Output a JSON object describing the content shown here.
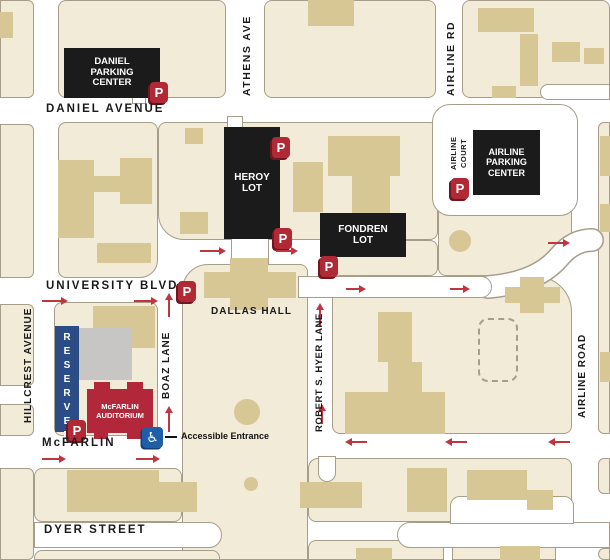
{
  "title": "Campus parking map - McFarlin Auditorium area",
  "colors": {
    "block_cream": "#f1ebd8",
    "block_border": "#a69d8b",
    "building_tan": "#d7c795",
    "building_gray": "#c7c6c4",
    "lot_black": "#1b1b1b",
    "parking_red": "#b12935",
    "arrow_red": "#c0353f",
    "reserved_blue": "#2c4c86",
    "accessible_blue": "#1f5fa8",
    "auditorium_red": "#b2283a",
    "street_white": "#ffffff"
  },
  "reserved": {
    "text": "RESERVED"
  },
  "auditorium": {
    "line1": "McFARLIN",
    "line2": "AUDITORIUM"
  },
  "accessible": {
    "symbol": "♿",
    "label": "Accessible Entrance"
  },
  "map": {
    "p_label": "P",
    "street_labels": [
      {
        "id": "daniel-avenue",
        "text": "DANIEL AVENUE",
        "x": 46,
        "y": 103,
        "size": 11.5,
        "ls": 2,
        "vertical": false
      },
      {
        "id": "university-blvd",
        "text": "UNIVERSITY BLVD",
        "x": 46,
        "y": 280,
        "size": 11.5,
        "ls": 2,
        "vertical": false
      },
      {
        "id": "mcfarlin",
        "text": "McFARLIN",
        "x": 42,
        "y": 437,
        "size": 11.5,
        "ls": 2,
        "vertical": false
      },
      {
        "id": "dyer-street",
        "text": "DYER STREET",
        "x": 44,
        "y": 524,
        "size": 11.5,
        "ls": 2,
        "vertical": false
      },
      {
        "id": "dallas-hall",
        "text": "DALLAS HALL",
        "x": 211,
        "y": 306,
        "size": 10,
        "ls": 1,
        "vertical": false
      },
      {
        "id": "athens-ave",
        "text": "ATHENS AVE",
        "x": 241,
        "y": 12,
        "h": 88,
        "size": 10.5,
        "ls": 1.5,
        "vertical": true
      },
      {
        "id": "airline-rd",
        "text": "AIRLINE RD",
        "x": 445,
        "y": 14,
        "h": 88,
        "size": 10.5,
        "ls": 1.5,
        "vertical": true
      },
      {
        "id": "airline-court-line1",
        "text": "AIRLINE",
        "x": 449,
        "y": 126,
        "h": 54,
        "size": 7.5,
        "ls": 0.5,
        "vertical": true
      },
      {
        "id": "airline-court-line2",
        "text": "COURT",
        "x": 459,
        "y": 126,
        "h": 54,
        "size": 7.5,
        "ls": 0.5,
        "vertical": true
      },
      {
        "id": "hillcrest-avenue",
        "text": "HILLCREST AVENUE",
        "x": 23,
        "y": 294,
        "h": 142,
        "size": 10,
        "ls": 1,
        "vertical": true
      },
      {
        "id": "boaz-lane",
        "text": "BOAZ LANE",
        "x": 161,
        "y": 316,
        "h": 98,
        "size": 10,
        "ls": 1,
        "vertical": true
      },
      {
        "id": "robert-s-hyer-lane",
        "text": "ROBERT S. HYER LANE",
        "x": 314,
        "y": 282,
        "h": 182,
        "size": 9.5,
        "ls": 0.5,
        "vertical": true
      },
      {
        "id": "airline-road",
        "text": "AIRLINE ROAD",
        "x": 577,
        "y": 314,
        "h": 124,
        "size": 10,
        "ls": 1,
        "vertical": true
      }
    ],
    "lots": [
      {
        "id": "daniel-parking-center",
        "lines": [
          "DANIEL",
          "PARKING",
          "CENTER"
        ],
        "x": 64,
        "y": 48,
        "w": 96,
        "h": 50,
        "size": 9.5
      },
      {
        "id": "heroy-lot",
        "lines": [
          "HEROY",
          "LOT"
        ],
        "x": 224,
        "y": 127,
        "w": 56,
        "h": 112,
        "size": 10
      },
      {
        "id": "fondren-lot",
        "lines": [
          "FONDREN",
          "LOT"
        ],
        "x": 320,
        "y": 213,
        "w": 86,
        "h": 44,
        "size": 10
      },
      {
        "id": "airline-parking-center",
        "lines": [
          "AIRLINE",
          "PARKING",
          "CENTER"
        ],
        "x": 473,
        "y": 130,
        "w": 67,
        "h": 65,
        "size": 9
      }
    ],
    "p_signs": [
      {
        "x": 150,
        "y": 82
      },
      {
        "x": 272,
        "y": 137
      },
      {
        "x": 274,
        "y": 228
      },
      {
        "x": 320,
        "y": 256
      },
      {
        "x": 178,
        "y": 281
      },
      {
        "x": 451,
        "y": 178
      },
      {
        "x": 68,
        "y": 420
      }
    ],
    "arrows": [
      {
        "x": 42,
        "y": 297,
        "dir": "right",
        "len": 26
      },
      {
        "x": 134,
        "y": 297,
        "dir": "right",
        "len": 24
      },
      {
        "x": 200,
        "y": 247,
        "dir": "right",
        "len": 26
      },
      {
        "x": 276,
        "y": 247,
        "dir": "right",
        "len": 22
      },
      {
        "x": 346,
        "y": 285,
        "dir": "right",
        "len": 20
      },
      {
        "x": 450,
        "y": 285,
        "dir": "right",
        "len": 20
      },
      {
        "x": 548,
        "y": 239,
        "dir": "right",
        "len": 22
      },
      {
        "x": 42,
        "y": 455,
        "dir": "right",
        "len": 24
      },
      {
        "x": 136,
        "y": 455,
        "dir": "right",
        "len": 24
      },
      {
        "x": 165,
        "y": 293,
        "dir": "up",
        "len": 24
      },
      {
        "x": 165,
        "y": 406,
        "dir": "up",
        "len": 26
      },
      {
        "x": 316,
        "y": 303,
        "dir": "up",
        "len": 24
      },
      {
        "x": 318,
        "y": 404,
        "dir": "up",
        "len": 20
      },
      {
        "x": 345,
        "y": 438,
        "dir": "left",
        "len": 22
      },
      {
        "x": 445,
        "y": 438,
        "dir": "left",
        "len": 22
      },
      {
        "x": 548,
        "y": 438,
        "dir": "left",
        "len": 22
      }
    ],
    "blocks": [
      {
        "x": 0,
        "y": 0,
        "w": 34,
        "h": 98,
        "r": "0 6px 6px 0"
      },
      {
        "x": 0,
        "y": 124,
        "w": 34,
        "h": 154,
        "r": "0 6px 6px 0"
      },
      {
        "x": 0,
        "y": 304,
        "w": 34,
        "h": 82,
        "r": "0 6px 6px 0"
      },
      {
        "x": 0,
        "y": 404,
        "w": 34,
        "h": 32,
        "r": "0 6px 6px 0"
      },
      {
        "x": 0,
        "y": 468,
        "w": 34,
        "h": 92,
        "r": "0 6px 6px 0"
      },
      {
        "x": 58,
        "y": 0,
        "w": 168,
        "h": 98,
        "r": "8px"
      },
      {
        "x": 264,
        "y": 0,
        "w": 172,
        "h": 98,
        "r": "8px"
      },
      {
        "x": 462,
        "y": 0,
        "w": 148,
        "h": 98,
        "r": "8px"
      },
      {
        "x": 58,
        "y": 122,
        "w": 100,
        "h": 156,
        "r": "8px 8px 18px 8px"
      },
      {
        "x": 158,
        "y": 122,
        "w": 280,
        "h": 118,
        "r": "8px 8px 8px 26px"
      },
      {
        "x": 332,
        "y": 240,
        "w": 106,
        "h": 36,
        "r": "0 8px 8px 8px"
      },
      {
        "x": 438,
        "y": 122,
        "w": 134,
        "h": 154,
        "r": "8px 8px 30px 8px"
      },
      {
        "x": 182,
        "y": 264,
        "w": 126,
        "h": 296,
        "r": "26px 8px 0 0"
      },
      {
        "x": 54,
        "y": 302,
        "w": 104,
        "h": 134,
        "r": "8px"
      },
      {
        "x": 34,
        "y": 468,
        "w": 148,
        "h": 54,
        "r": "8px"
      },
      {
        "x": 34,
        "y": 550,
        "w": 186,
        "h": 10,
        "r": "8px 8px 0 0"
      },
      {
        "x": 332,
        "y": 276,
        "w": 240,
        "h": 158,
        "r": "0 36px 8px 8px"
      },
      {
        "x": 308,
        "y": 458,
        "w": 264,
        "h": 64,
        "r": "10px 8px 20px 8px"
      },
      {
        "x": 308,
        "y": 540,
        "w": 136,
        "h": 20,
        "r": "8px 8px 0 0"
      },
      {
        "x": 452,
        "y": 540,
        "w": 104,
        "h": 20,
        "r": "8px 8px 0 0"
      },
      {
        "x": 598,
        "y": 122,
        "w": 12,
        "h": 312,
        "r": "6px 0 0 6px"
      },
      {
        "x": 598,
        "y": 458,
        "w": 12,
        "h": 36,
        "r": "6px 0 0 6px"
      },
      {
        "x": 598,
        "y": 548,
        "w": 12,
        "h": 12,
        "r": "6px 0 0 6px"
      },
      {
        "x": 436,
        "y": 136,
        "w": 22,
        "h": 60,
        "r": "11px"
      },
      {
        "x": 548,
        "y": 150,
        "w": 26,
        "h": 62,
        "r": "10px"
      }
    ],
    "roads": [
      {
        "x": 540,
        "y": 84,
        "w": 70,
        "h": 16,
        "r": "8px 0 0 8px"
      },
      {
        "x": 432,
        "y": 104,
        "w": 146,
        "h": 112,
        "r": "18px"
      },
      {
        "x": 34,
        "y": 522,
        "w": 188,
        "h": 26,
        "r": "0 13px 13px 0"
      },
      {
        "x": 397,
        "y": 522,
        "w": 213,
        "h": 26,
        "r": "13px 0 0 13px"
      },
      {
        "x": 450,
        "y": 496,
        "w": 124,
        "h": 28,
        "r": "10px 10px 0 0"
      },
      {
        "x": 298,
        "y": 276,
        "w": 194,
        "h": 22,
        "r": "0 11px 11px 0"
      },
      {
        "x": 318,
        "y": 456,
        "w": 18,
        "h": 26,
        "r": "0 0 9px 9px"
      },
      {
        "x": 227,
        "y": 116,
        "w": 16,
        "h": 12,
        "r": "0"
      },
      {
        "x": 231,
        "y": 236,
        "w": 38,
        "h": 28,
        "r": "0"
      },
      {
        "x": 132,
        "y": 94,
        "w": 14,
        "h": 10,
        "r": "0"
      }
    ],
    "structures": [
      {
        "x": 0,
        "y": 12,
        "w": 13,
        "h": 26
      },
      {
        "x": 58,
        "y": 160,
        "w": 36,
        "h": 78
      },
      {
        "x": 92,
        "y": 176,
        "w": 30,
        "h": 16
      },
      {
        "x": 120,
        "y": 158,
        "w": 32,
        "h": 46
      },
      {
        "x": 97,
        "y": 243,
        "w": 54,
        "h": 20
      },
      {
        "x": 180,
        "y": 212,
        "w": 28,
        "h": 22
      },
      {
        "x": 185,
        "y": 128,
        "w": 18,
        "h": 16
      },
      {
        "x": 293,
        "y": 162,
        "w": 30,
        "h": 50
      },
      {
        "x": 328,
        "y": 136,
        "w": 72,
        "h": 40
      },
      {
        "x": 352,
        "y": 176,
        "w": 38,
        "h": 58
      },
      {
        "x": 308,
        "y": 0,
        "w": 46,
        "h": 26
      },
      {
        "x": 478,
        "y": 8,
        "w": 56,
        "h": 24
      },
      {
        "x": 520,
        "y": 34,
        "w": 18,
        "h": 52
      },
      {
        "x": 552,
        "y": 42,
        "w": 28,
        "h": 20
      },
      {
        "x": 584,
        "y": 48,
        "w": 20,
        "h": 16
      },
      {
        "x": 492,
        "y": 86,
        "w": 24,
        "h": 12
      },
      {
        "x": 600,
        "y": 136,
        "w": 10,
        "h": 40
      },
      {
        "x": 600,
        "y": 204,
        "w": 10,
        "h": 28
      },
      {
        "x": 600,
        "y": 352,
        "w": 10,
        "h": 30
      },
      {
        "x": 378,
        "y": 312,
        "w": 34,
        "h": 50
      },
      {
        "x": 388,
        "y": 362,
        "w": 34,
        "h": 32
      },
      {
        "x": 345,
        "y": 392,
        "w": 100,
        "h": 42
      },
      {
        "x": 520,
        "y": 277,
        "w": 24,
        "h": 36
      },
      {
        "x": 505,
        "y": 287,
        "w": 55,
        "h": 16
      },
      {
        "x": 204,
        "y": 272,
        "w": 92,
        "h": 26
      },
      {
        "x": 230,
        "y": 258,
        "w": 38,
        "h": 52
      },
      {
        "x": 93,
        "y": 306,
        "w": 62,
        "h": 42
      },
      {
        "x": 78,
        "y": 328,
        "w": 54,
        "h": 52,
        "variant": "gray"
      },
      {
        "x": 478,
        "y": 318,
        "w": 40,
        "h": 64,
        "variant": "dashed"
      },
      {
        "x": 67,
        "y": 470,
        "w": 92,
        "h": 14
      },
      {
        "x": 67,
        "y": 482,
        "w": 130,
        "h": 30
      },
      {
        "x": 300,
        "y": 482,
        "w": 62,
        "h": 26
      },
      {
        "x": 407,
        "y": 468,
        "w": 40,
        "h": 44
      },
      {
        "x": 467,
        "y": 470,
        "w": 60,
        "h": 30
      },
      {
        "x": 527,
        "y": 490,
        "w": 26,
        "h": 20
      },
      {
        "x": 356,
        "y": 548,
        "w": 36,
        "h": 12
      },
      {
        "x": 500,
        "y": 546,
        "w": 40,
        "h": 14
      },
      {
        "x": 234,
        "y": 399,
        "w": 26,
        "h": 26,
        "variant": "tree"
      },
      {
        "x": 244,
        "y": 477,
        "w": 14,
        "h": 14,
        "variant": "tree"
      },
      {
        "x": 449,
        "y": 230,
        "w": 22,
        "h": 22,
        "variant": "tree"
      }
    ]
  }
}
